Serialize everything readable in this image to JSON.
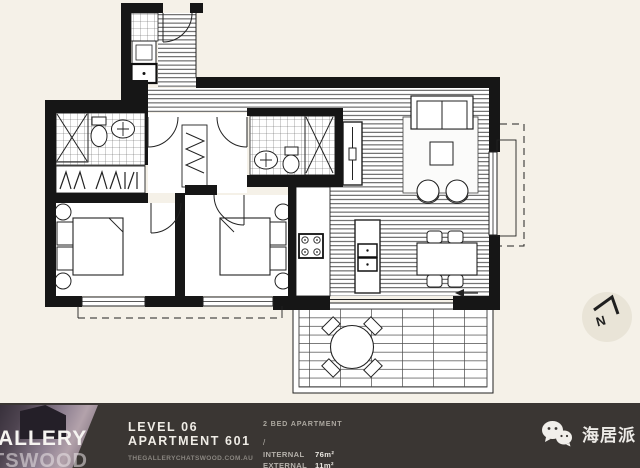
{
  "plan": {
    "north_label": "N"
  },
  "footer": {
    "logo_line1": "ALLERY",
    "logo_line2": "TSWOOD",
    "level": "LEVEL 06",
    "apartment": "APARTMENT 601",
    "website": "THEGALLERYCHATSWOOD.COM.AU",
    "apartment_type": "2 BED APARTMENT",
    "divider": "/",
    "areas": [
      {
        "label": "INTERNAL",
        "value": "76m²"
      },
      {
        "label": "EXTERNAL",
        "value": "11m²"
      }
    ],
    "badge_text": "海居派"
  },
  "colors": {
    "background": "#f5f1e8",
    "footer_bg": "#3a3633",
    "plan_line": "#1b1b1b",
    "north_circle": "#e9e4d7"
  }
}
